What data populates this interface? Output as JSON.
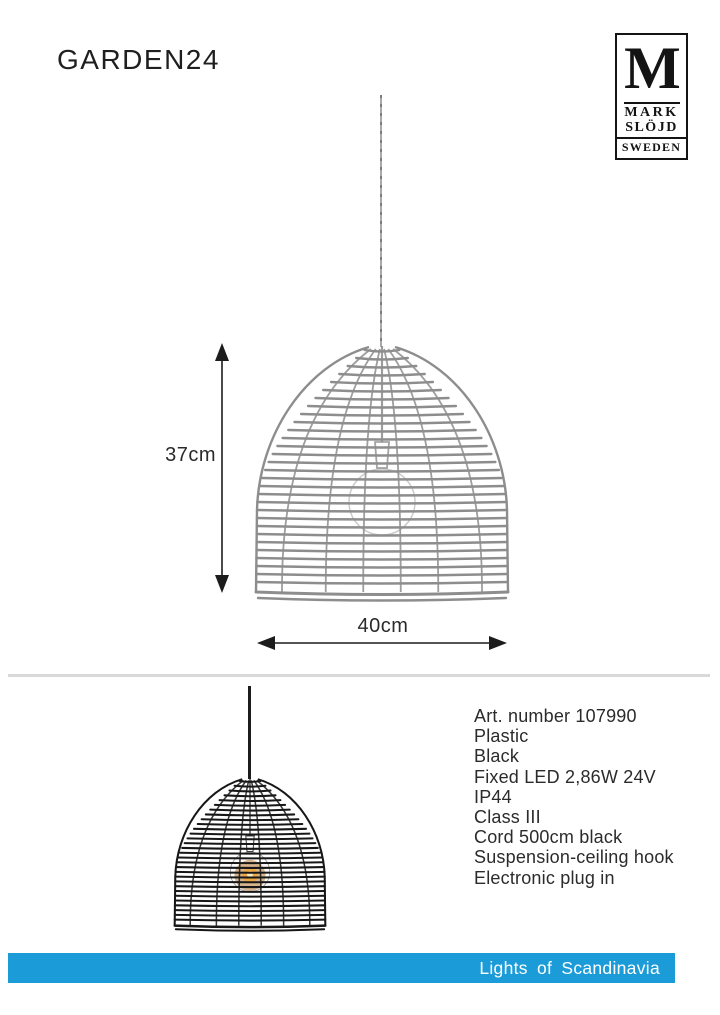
{
  "title": "GARDEN24",
  "logo": {
    "monogram": "M",
    "name_line1": "MARK",
    "name_line2": "SLÖJD",
    "country": "SWEDEN"
  },
  "diagram": {
    "height_label": "37cm",
    "width_label": "40cm"
  },
  "specs": {
    "lines": [
      "Art. number 107990",
      "Plastic",
      "Black",
      "Fixed LED 2,86W 24V",
      "IP44",
      "Class III",
      "Cord 500cm black",
      "Suspension-ceiling hook",
      "Electronic plug in"
    ]
  },
  "footer": {
    "label": "Lights of Scandinavia",
    "bar_color": "#1b9cd8"
  },
  "colors": {
    "drawing_stroke": "#8d8d8d",
    "black_lamp": "#171717",
    "arrow": "#1c1c1c"
  }
}
